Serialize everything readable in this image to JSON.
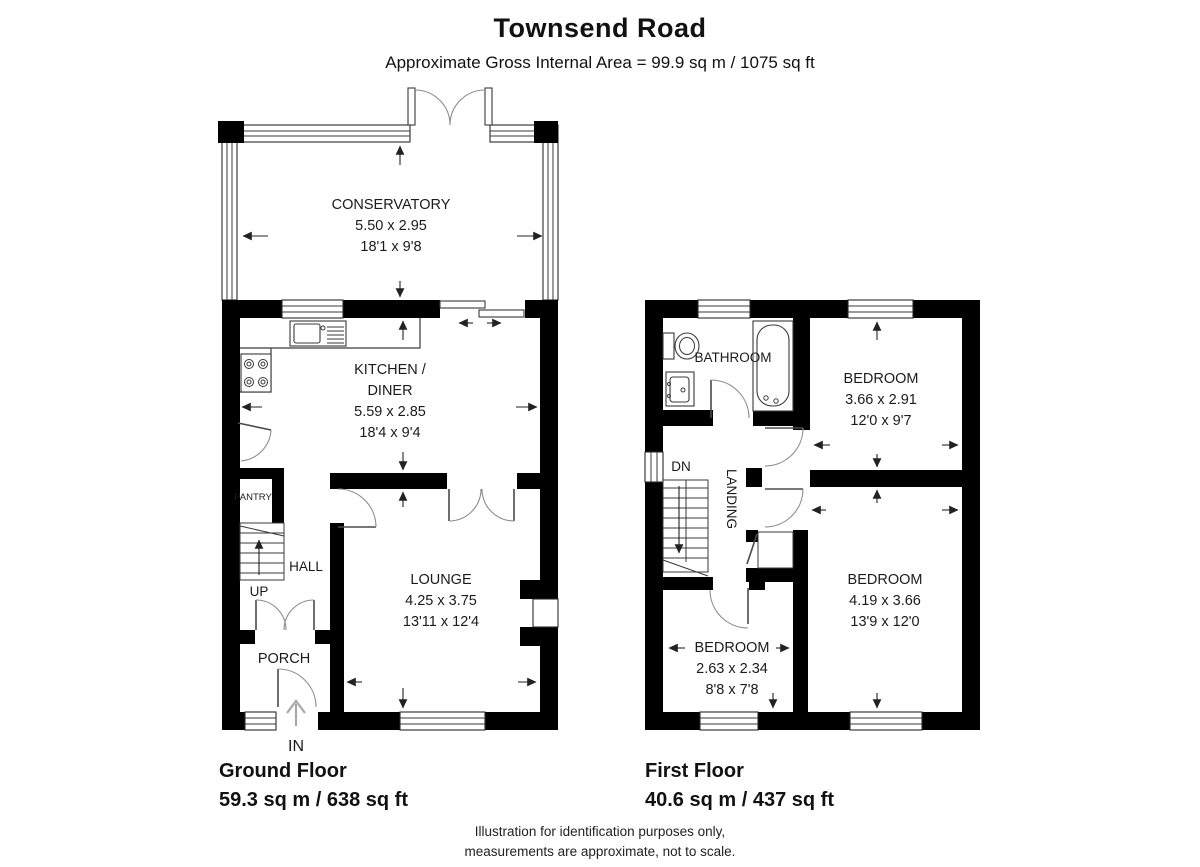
{
  "header": {
    "title": "Townsend Road",
    "subtitle": "Approximate Gross Internal Area = 99.9 sq m / 1075 sq ft"
  },
  "ground_floor": {
    "name": "Ground Floor",
    "area": "59.3 sq m / 638 sq ft",
    "conservatory": {
      "name": "CONSERVATORY",
      "metric": "5.50 x 2.95",
      "imperial": "18'1 x 9'8"
    },
    "kitchen": {
      "name_line1": "KITCHEN /",
      "name_line2": "DINER",
      "metric": "5.59 x 2.85",
      "imperial": "18'4 x 9'4"
    },
    "lounge": {
      "name": "LOUNGE",
      "metric": "4.25 x 3.75",
      "imperial": "13'11 x 12'4"
    },
    "pantry": {
      "name": "PANTRY"
    },
    "hall": {
      "name": "HALL"
    },
    "porch": {
      "name": "PORCH"
    },
    "stairs_label": "UP",
    "entrance_label": "IN"
  },
  "first_floor": {
    "name": "First Floor",
    "area": "40.6 sq m / 437 sq ft",
    "bathroom": {
      "name": "BATHROOM"
    },
    "bedroom_front": {
      "name": "BEDROOM",
      "metric": "3.66 x 2.91",
      "imperial": "12'0 x 9'7"
    },
    "bedroom_rear": {
      "name": "BEDROOM",
      "metric": "4.19 x 3.66",
      "imperial": "13'9 x 12'0"
    },
    "bedroom_small": {
      "name": "BEDROOM",
      "metric": "2.63 x 2.34",
      "imperial": "8'8 x 7'8"
    },
    "landing": {
      "name": "LANDING"
    },
    "stairs_label": "DN"
  },
  "footer": {
    "disclaimer_line1": "Illustration for identification purposes only,",
    "disclaimer_line2": "measurements are approximate, not to scale."
  },
  "colors": {
    "wall": "#000000",
    "line": "#3a3a3a",
    "door_arc": "#8c8c8c",
    "background": "#ffffff"
  }
}
